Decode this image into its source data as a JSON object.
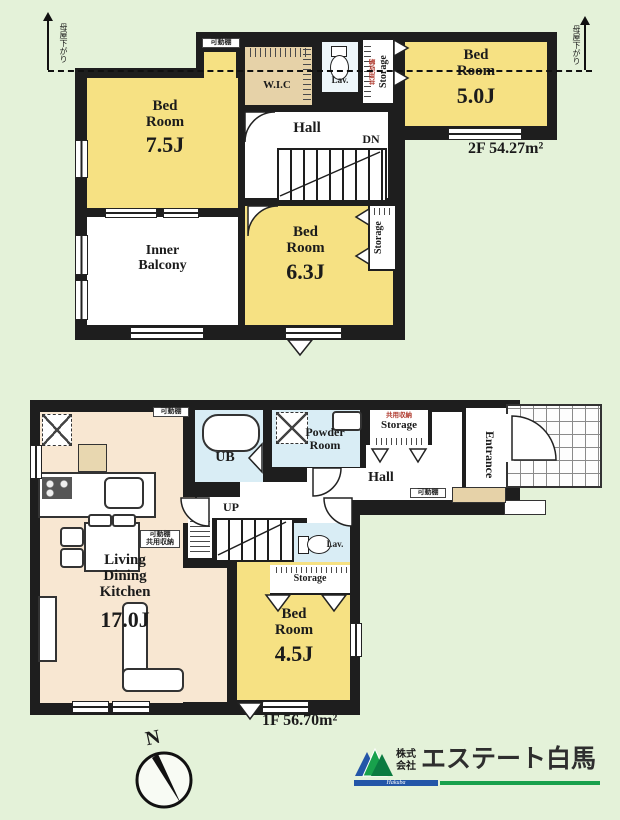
{
  "palette": {
    "background": "#e4f2d9",
    "wall": "#1e1e1e",
    "room_yellow": "#f6e183",
    "room_peach": "#f8e7d2",
    "room_blue": "#d9edf5",
    "closet_tan": "#e6d2a8",
    "logo_blue": "#2356a8",
    "logo_green": "#18a14c"
  },
  "f2": {
    "area": "2F 54.27m²",
    "noteL": "母屋下がり",
    "noteR": "母屋下がり",
    "shelf": "可動棚",
    "bed75": {
      "name": "Bed\nRoom",
      "size": "7.5J"
    },
    "bed50": {
      "name": "Bed\nRoom",
      "size": "5.0J"
    },
    "bed63": {
      "name": "Bed\nRoom",
      "size": "6.3J"
    },
    "balcony": "Inner\nBalcony",
    "hall": "Hall",
    "dn": "DN",
    "wic": "W.I.C",
    "lav": "Lav.",
    "stHall": {
      "sub": "共用収納",
      "name": "Storage"
    },
    "stBed": {
      "name": "Storage"
    }
  },
  "f1": {
    "area": "1F 56.70m²",
    "ldk": {
      "name": "Living\nDining\nKitchen",
      "size": "17.0J"
    },
    "bed45": {
      "name": "Bed\nRoom",
      "size": "4.5J"
    },
    "ub": "UB",
    "powder": "Powder\nRoom",
    "hall": "Hall",
    "up": "UP",
    "lav": "Lav.",
    "entrance": "Entrance",
    "stHall": {
      "sub": "共用収納",
      "name": "Storage"
    },
    "stBed": {
      "name": "Storage"
    },
    "shelfTop": "可動棚",
    "shelfHall": "可動棚",
    "shelfMid": "可動棚\n共用収納"
  },
  "compass": {
    "n": "N"
  },
  "logo": {
    "prefix": "株式\n会社",
    "name": "エステート白馬",
    "script": "Hakuba"
  }
}
